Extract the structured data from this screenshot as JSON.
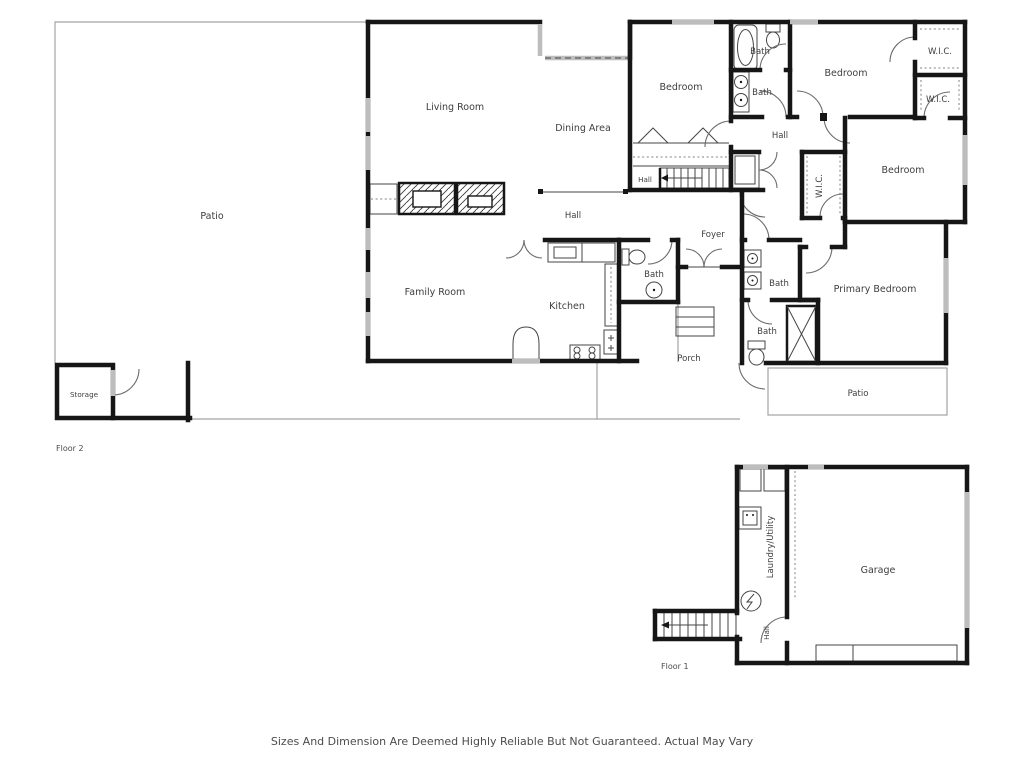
{
  "footer": {
    "disclaimer": "Sizes And Dimension Are Deemed Highly Reliable But Not Guaranteed. Actual May Vary"
  },
  "floors": {
    "floor2_label": "Floor 2",
    "floor1_label": "Floor 1"
  },
  "rooms": {
    "patio": "Patio",
    "living_room": "Living Room",
    "dining_area": "Dining Area",
    "bedroom": "Bedroom",
    "primary_bedroom": "Primary Bedroom",
    "family_room": "Family Room",
    "kitchen": "Kitchen",
    "foyer": "Foyer",
    "hall": "Hall",
    "bath": "Bath",
    "wic": "W.I.C.",
    "storage": "Storage",
    "porch": "Porch",
    "garage": "Garage",
    "laundry_utility": "Laundry/Utility"
  },
  "colors": {
    "wall": "#161616",
    "window": "#bdbdbd",
    "thin_line": "#454545",
    "exterior_outline": "#a3a3a3",
    "door_arc": "#6b6b6b",
    "label_text": "#3e3e3e",
    "background": "#ffffff"
  }
}
